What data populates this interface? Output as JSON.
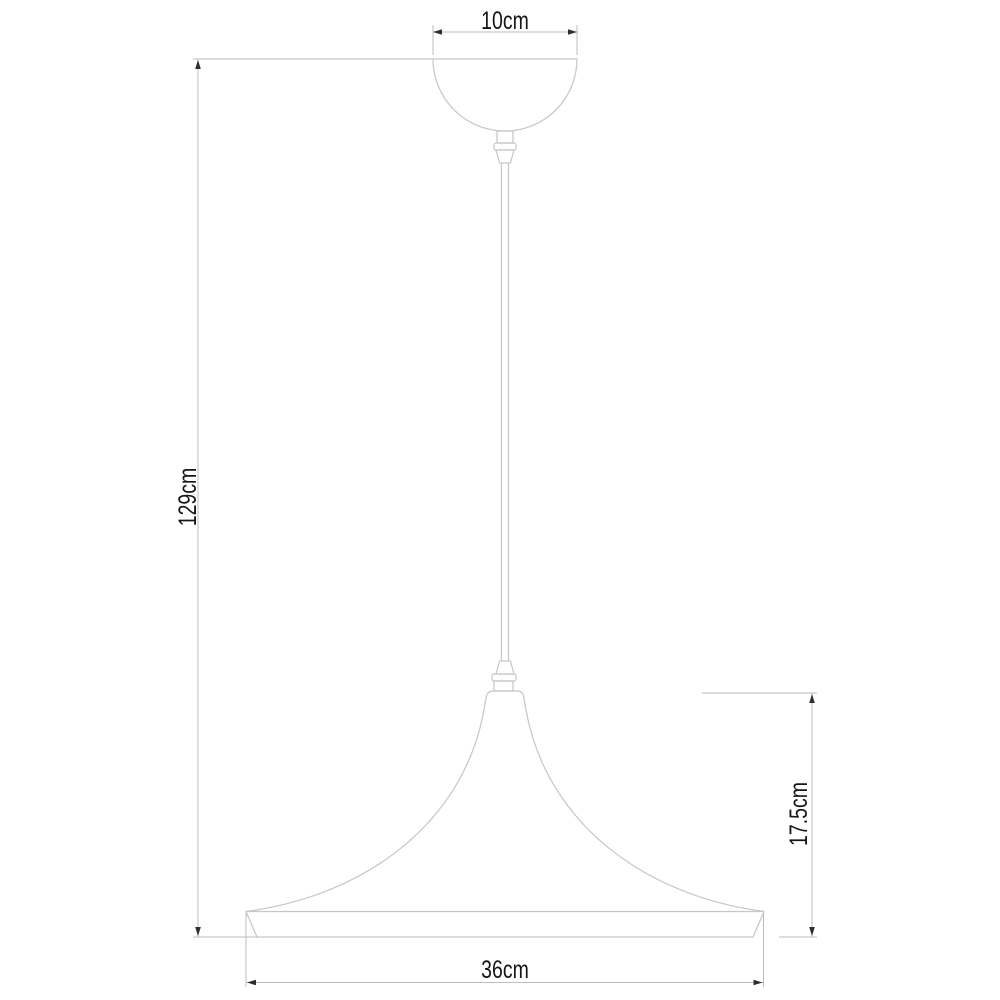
{
  "drawing": {
    "subject": "pendant-lamp-dimension-diagram"
  },
  "dimension_labels": {
    "canopy_diameter": "10cm",
    "overall_drop": "129cm",
    "shade_height": "17.5cm",
    "shade_diameter": "36cm"
  },
  "colors": {
    "background": "#ffffff",
    "lamp_outline": "#c6c6c6",
    "dimension_line": "#bdbdbd",
    "arrow": "#2e2e2e",
    "text": "#161616"
  }
}
